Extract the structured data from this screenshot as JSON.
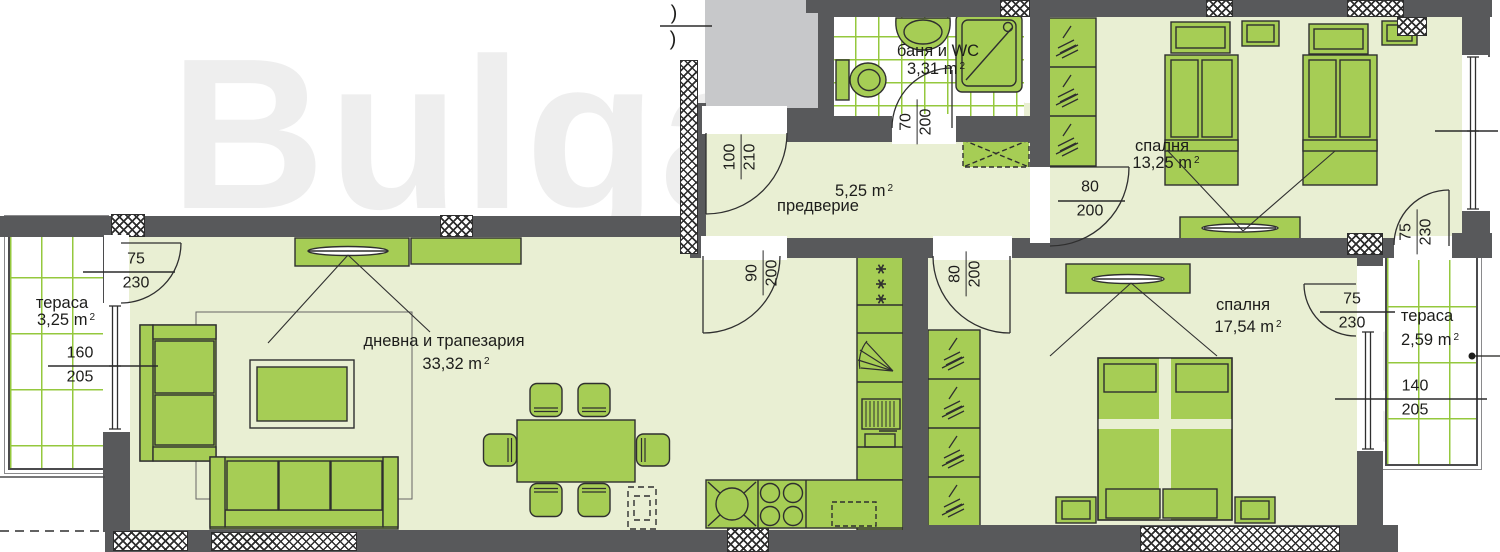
{
  "watermark": {
    "line1": "Bulgarian",
    "line2": "Properties"
  },
  "rooms": {
    "bathroom": {
      "name": "баня и WC",
      "area": "3,31 m",
      "sup": "2"
    },
    "hallway": {
      "name": "предверие",
      "area": "5,25 m",
      "sup": "2"
    },
    "bedroom1": {
      "name": "спалня",
      "area": "13,25 m",
      "sup": "2"
    },
    "living": {
      "name": "дневна и трапезария",
      "area": "33,32 m",
      "sup": "2"
    },
    "bedroom2": {
      "name": "спалня",
      "area": "17,54 m",
      "sup": "2"
    },
    "terrace_left": {
      "name": "тераса",
      "area": "3,25 m",
      "sup": "2"
    },
    "terrace_right": {
      "name": "тераса",
      "area": "2,59 m",
      "sup": "2"
    }
  },
  "dims": {
    "entrance_door": {
      "a": "100",
      "b": "210"
    },
    "bath_door": {
      "a": "70",
      "b": "200"
    },
    "bedroom1_door": {
      "a": "80",
      "b": "200"
    },
    "living_opening": {
      "a": "90",
      "b": "200"
    },
    "bedroom2_door": {
      "a": "80",
      "b": "200"
    },
    "terrace_left_door": {
      "a": "75",
      "b": "230"
    },
    "terrace_left_window": {
      "a": "160",
      "b": "205"
    },
    "bedroom1_terrace_door": {
      "a": "75",
      "b": "230"
    },
    "bedroom2_terrace_door": {
      "a": "75",
      "b": "230"
    },
    "terrace_right_window": {
      "a": "140",
      "b": "205"
    }
  },
  "edge_marks": {
    "top": ")",
    "bottom": ")"
  },
  "colors": {
    "wall": "#58595b",
    "furniture": "#a6cd55",
    "room_fill": "#e9efd3",
    "tile_line": "#95c83e",
    "grey_block": "#c7c8ca"
  }
}
